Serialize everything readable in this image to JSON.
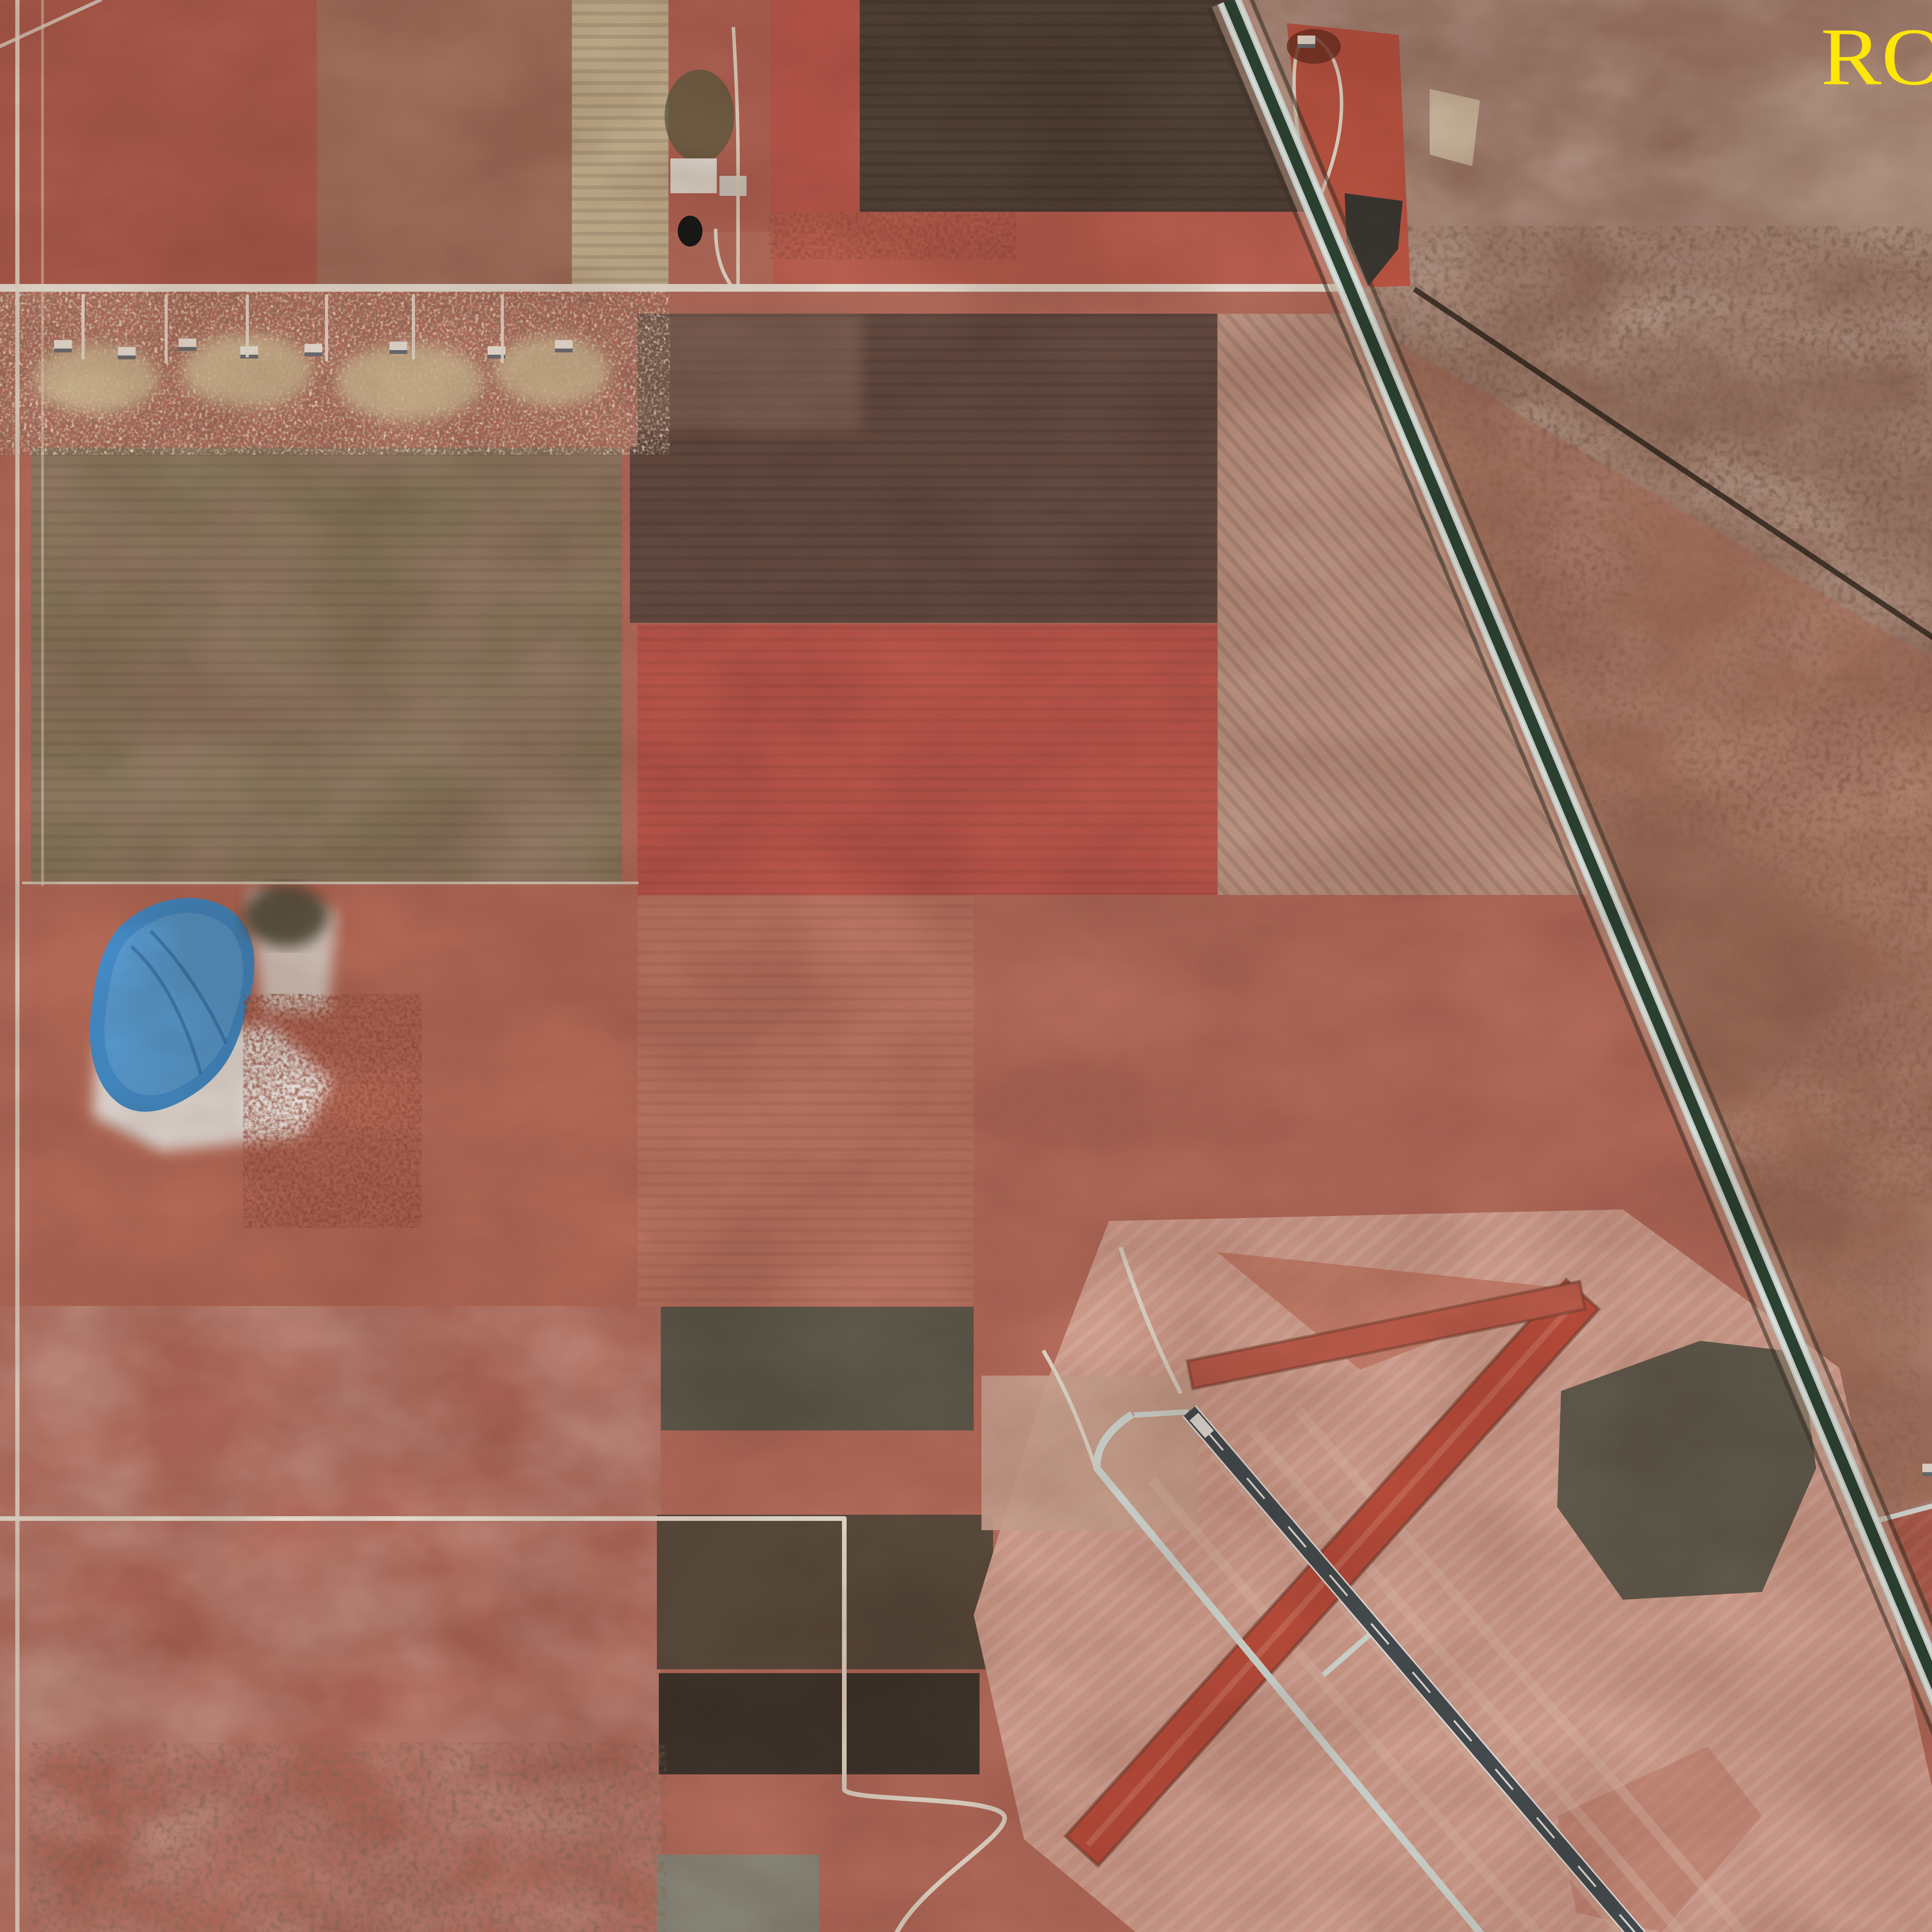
{
  "overlays": {
    "photo_id": "ROS-32-003 stereo",
    "caption": "STEREO PAIR FOR PHOTO # ROS-32-003",
    "text_color": "#ffe60a"
  },
  "palette": {
    "farmland_pink": "#b96c5b",
    "bright_red_field": "#c2554a",
    "dark_plowed_field": "#4e3d32",
    "olive_field": "#857a57",
    "scrub_brown": "#9b7260",
    "forest_red": "#8c3322",
    "pond_blue": "#3f8fd4",
    "dark_water": "#14120e",
    "road_white": "#efeadf",
    "highway_lane": "#d4e6e6",
    "highway_median": "#25402e",
    "runway_pavement": "#414a4f",
    "turf_runway_red": "#c04a38",
    "airport_grass": "#d6a291"
  },
  "features": [
    "divided-highway",
    "secondary-highway",
    "main-runway",
    "parallel-taxiway",
    "crosswind-turf-runway",
    "turf-strip",
    "apron-and-hangars",
    "blue-pond",
    "forest-block",
    "golf-community",
    "marina",
    "mobile-home-park",
    "farmsteads"
  ]
}
